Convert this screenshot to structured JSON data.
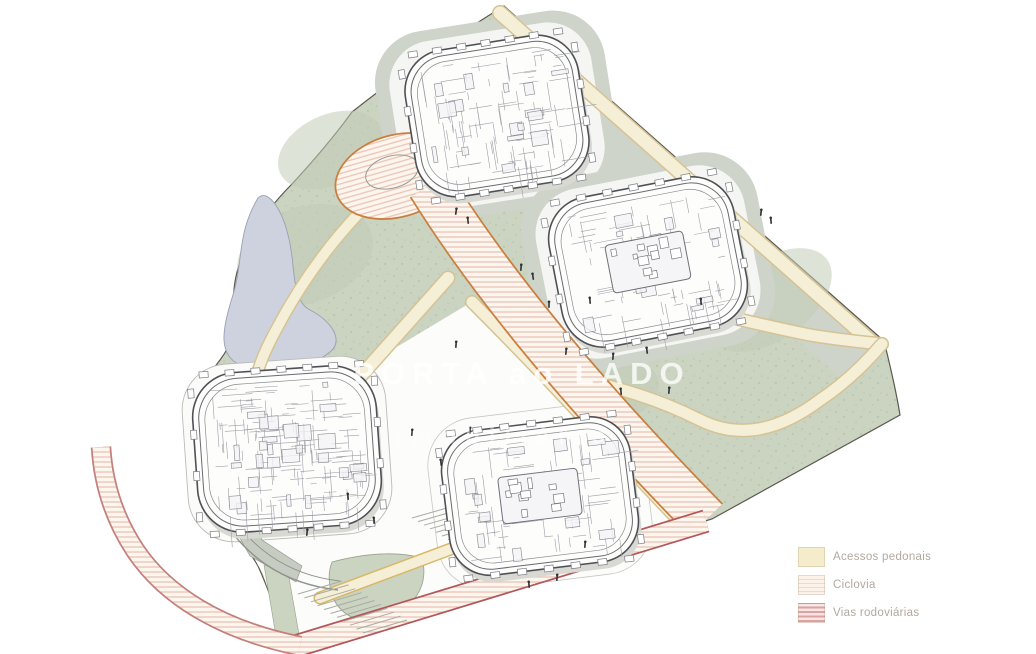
{
  "watermark": {
    "line1": "PORTA ao LADO",
    "line2": "imobiliária"
  },
  "legend": {
    "items": [
      {
        "label": "Acessos pedonais",
        "swatch": {
          "type": "solid",
          "bg": "#f4ecca",
          "stripe": "",
          "period": 0,
          "stripe_h": 0
        }
      },
      {
        "label": "Ciclovia",
        "swatch": {
          "type": "stripes",
          "bg": "#fdf2e9",
          "stripe": "#f2d8cc",
          "period": 4,
          "stripe_h": 1.2
        }
      },
      {
        "label": "Vias rodoviárias",
        "swatch": {
          "type": "stripes",
          "bg": "#f7e6e3",
          "stripe": "#dda0a3",
          "period": 4.5,
          "stripe_h": 2.2
        }
      }
    ]
  },
  "colors": {
    "site_green": "#cbd3c1",
    "green_speckle": "#9fae90",
    "green_patch_edge": "#97a08d",
    "outline": "#5a594f",
    "pond": "#cdd2de",
    "pond_edge": "#99a0b2",
    "plaza": "#fcfcfa",
    "band_gray": "#ced4ca",
    "path_fill": "#f6efd8",
    "path_edge": "#d4c394",
    "path_edge_yellow": "#d8b865",
    "road_bg": "#fcf7ee",
    "road_stripe": "#ecc3b6",
    "road_edge": "#c9803f",
    "road_edge_red": "#b2575b",
    "branch_edge": "#c4807c",
    "wall_gray": "#c6ccc2",
    "wall_line": "#8e948a",
    "stair_line": "#a9aca4",
    "building_line": "#4f5055",
    "building_fill": "#fdfdfc",
    "people": "#303034",
    "legend_text": "#b3a89e"
  }
}
